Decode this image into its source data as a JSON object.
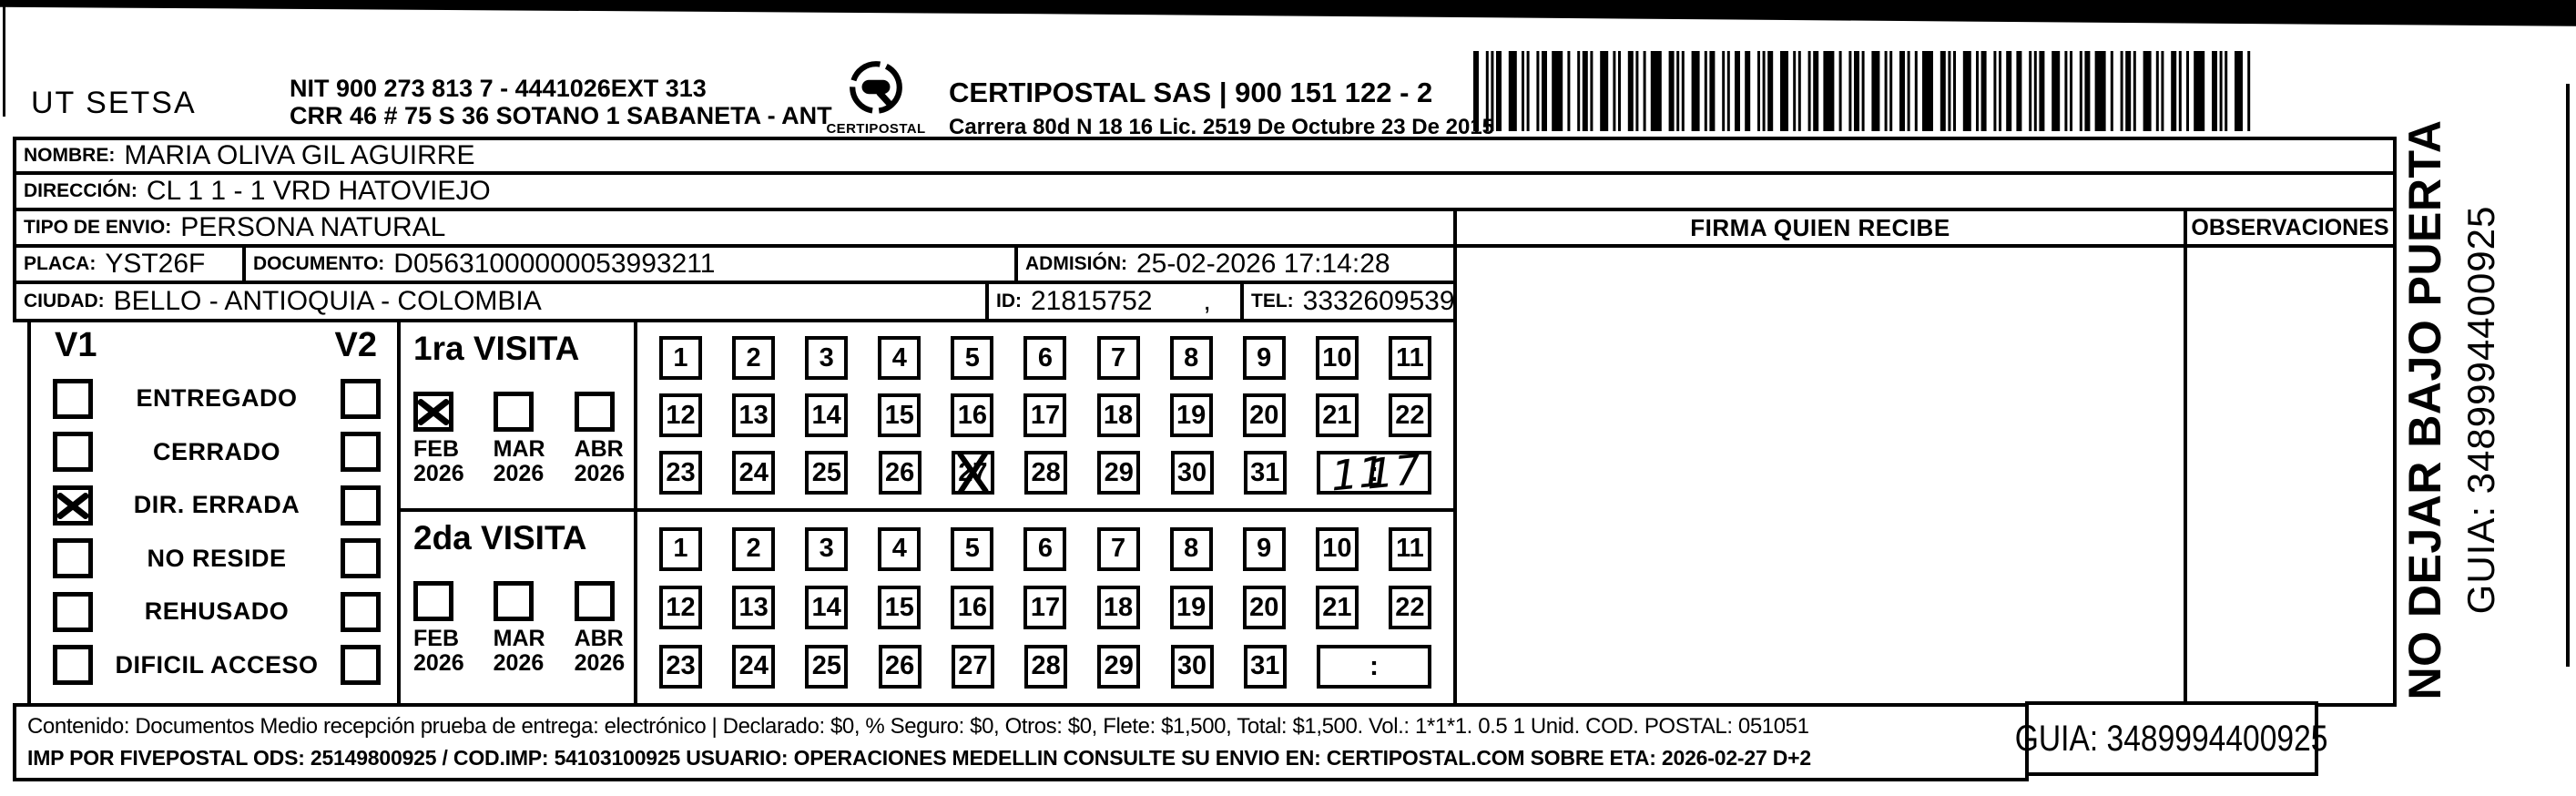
{
  "header": {
    "sender": "UT SETSA",
    "nit_line1": "NIT 900 273 813 7 - 4441026EXT 313",
    "nit_line2": "CRR 46 # 75 S 36 SOTANO 1 SABANETA - ANT",
    "logo_caption": "CERTIPOSTAL",
    "company_line1": "CERTIPOSTAL SAS | 900 151 122 - 2",
    "company_line2": "Carrera 80d N 18 16  Lic. 2519 De Octubre 23 De 2015"
  },
  "fields": {
    "nombre_label": "NOMBRE:",
    "nombre": "MARIA OLIVA GIL AGUIRRE",
    "direccion_label": "DIRECCIÓN:",
    "direccion": "CL 1 1 - 1 VRD HATOVIEJO",
    "tipo_envio_label": "TIPO DE ENVIO:",
    "tipo_envio": "PERSONA NATURAL",
    "placa_label": "PLACA:",
    "placa": "YST26F",
    "documento_label": "DOCUMENTO:",
    "documento": "D05631000000053993211",
    "admision_label": "ADMISIÓN:",
    "admision": "25-02-2026 17:14:28",
    "ciudad_label": "CIUDAD:",
    "ciudad": "BELLO - ANTIOQUIA - COLOMBIA",
    "id_label": "ID:",
    "id_value": "21815752",
    "id_suffix": ",",
    "tel_label": "TEL:",
    "tel": "3332609539"
  },
  "status_panel": {
    "col1_label": "V1",
    "col2_label": "V2",
    "options": [
      {
        "label": "ENTREGADO",
        "v1": false,
        "v2": false
      },
      {
        "label": "CERRADO",
        "v1": false,
        "v2": false
      },
      {
        "label": "DIR. ERRADA",
        "v1": true,
        "v2": false
      },
      {
        "label": "NO RESIDE",
        "v1": false,
        "v2": false
      },
      {
        "label": "REHUSADO",
        "v1": false,
        "v2": false
      },
      {
        "label": "DIFICIL ACCESO",
        "v1": false,
        "v2": false
      }
    ]
  },
  "visits": [
    {
      "title": "1ra VISITA",
      "months": [
        {
          "label": "FEB",
          "year": "2026",
          "checked": true
        },
        {
          "label": "MAR",
          "year": "2026",
          "checked": false
        },
        {
          "label": "ABR",
          "year": "2026",
          "checked": false
        }
      ],
      "day_rows": [
        [
          1,
          2,
          3,
          4,
          5,
          6,
          7,
          8,
          9,
          10,
          11
        ],
        [
          12,
          13,
          14,
          15,
          16,
          17,
          18,
          19,
          20,
          21,
          22
        ],
        [
          23,
          24,
          25,
          26,
          27,
          28,
          29,
          30,
          31
        ]
      ],
      "crossed_day": 27,
      "time_printed": ":",
      "time_handwritten": "11:17"
    },
    {
      "title": "2da VISITA",
      "months": [
        {
          "label": "FEB",
          "year": "2026",
          "checked": false
        },
        {
          "label": "MAR",
          "year": "2026",
          "checked": false
        },
        {
          "label": "ABR",
          "year": "2026",
          "checked": false
        }
      ],
      "day_rows": [
        [
          1,
          2,
          3,
          4,
          5,
          6,
          7,
          8,
          9,
          10,
          11
        ],
        [
          12,
          13,
          14,
          15,
          16,
          17,
          18,
          19,
          20,
          21,
          22
        ],
        [
          23,
          24,
          25,
          26,
          27,
          28,
          29,
          30,
          31
        ]
      ],
      "crossed_day": null,
      "time_printed": ":",
      "time_handwritten": ""
    }
  ],
  "signature": {
    "firma_header": "FIRMA QUIEN RECIBE",
    "observaciones_header": "OBSERVACIONES"
  },
  "side_note": {
    "line1": "NO DEJAR BAJO PUERTA",
    "line2": "GUIA: 3489994400925"
  },
  "footer": {
    "line1": "Contenido: Documentos Medio recepción prueba de entrega: electrónico | Declarado: $0, % Seguro: $0, Otros: $0, Flete: $1,500, Total: $1,500. Vol.: 1*1*1. 0.5  1 Unid. COD. POSTAL: 051051",
    "line2": "IMP POR FIVEPOSTAL ODS: 25149800925 / COD.IMP: 54103100925 USUARIO: OPERACIONES MEDELLIN CONSULTE SU ENVIO EN: CERTIPOSTAL.COM SOBRE ETA: 2026-02-27 D+2",
    "guia": "GUIA: 3489994400925"
  }
}
